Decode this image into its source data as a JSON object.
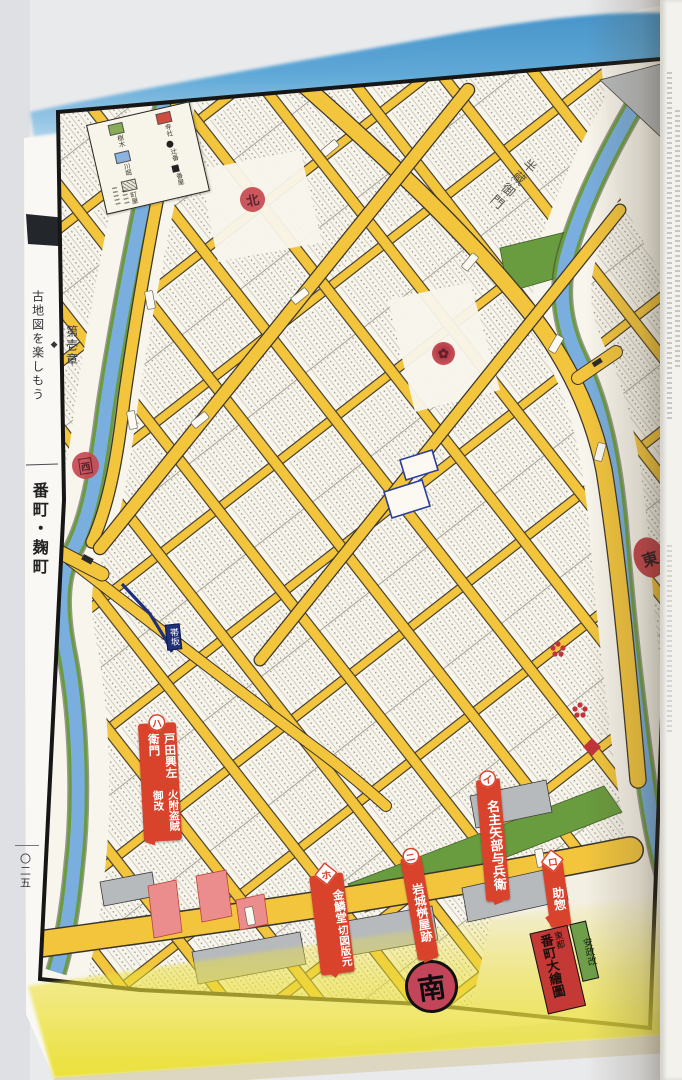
{
  "page": {
    "chapter": {
      "number": "第壱章",
      "separator": "◆",
      "title": "古地図を楽しもう"
    },
    "section_title": "番町・麹町",
    "page_number": "〇二五"
  },
  "map": {
    "cartouche": {
      "edition": "安政改",
      "region": "東都",
      "title": "番町大繪圖"
    },
    "legend": {
      "items": [
        {
          "label": "寺社",
          "swatch": "red"
        },
        {
          "label": "辻番",
          "swatch": "dot"
        },
        {
          "label": "番屋",
          "swatch": "square"
        },
        {
          "label": "樹木",
          "swatch": "green"
        },
        {
          "label": "川堀",
          "swatch": "blue"
        },
        {
          "label": "町屋",
          "swatch": "hatch"
        }
      ]
    },
    "direction_seals": {
      "north": "北",
      "south": "南",
      "east": "東",
      "west": "西"
    },
    "slope_label": "帯坂",
    "road_label": "半蔵御門",
    "markers": [
      {
        "badge": "イ",
        "badge_shape": "circle",
        "lines": [
          "名主矢部与兵衛"
        ]
      },
      {
        "badge": "ロ",
        "badge_shape": "diamond",
        "lines": [
          "助惣"
        ]
      },
      {
        "badge": "ハ",
        "badge_shape": "circle",
        "lines": [
          "火附盗賊御改",
          "戸田興左衛門"
        ]
      },
      {
        "badge": "ニ",
        "badge_shape": "circle",
        "lines": [
          "岩城桝屋跡"
        ]
      },
      {
        "badge": "ホ",
        "badge_shape": "diamond",
        "lines": [
          "切図版元",
          "金鱗堂"
        ]
      }
    ],
    "colors": {
      "road": "#f2c53d",
      "river": "#79aede",
      "bank": "#699b3f",
      "block": "#f8f5ec",
      "marker": "#d9432c",
      "seal": "#c84a52",
      "south_seal": "#c2455a",
      "navy": "#20307a"
    }
  },
  "icons": {
    "crest_seal": "✿"
  }
}
